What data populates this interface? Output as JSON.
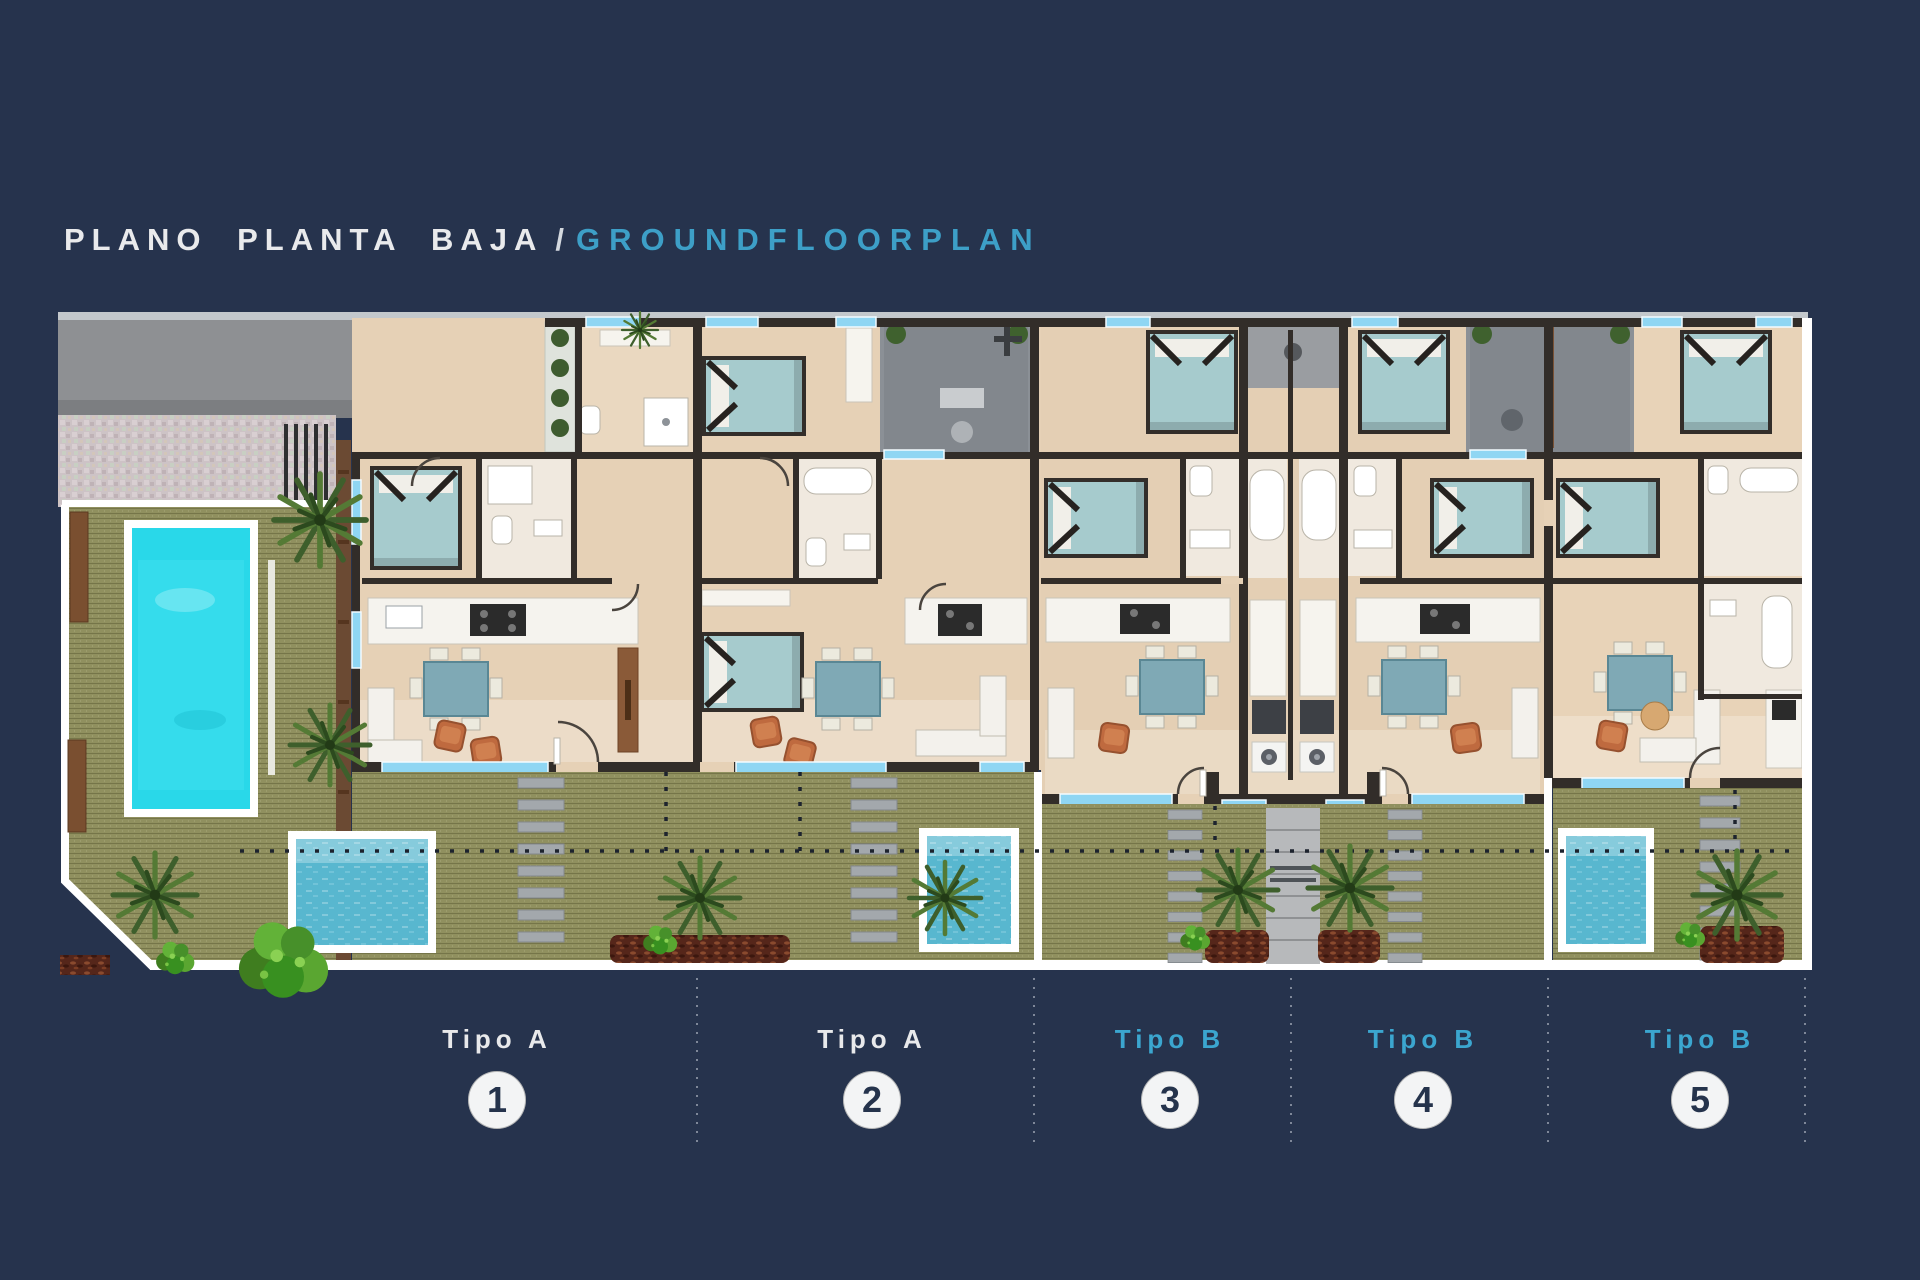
{
  "title": {
    "main": "PLANO PLANTA BAJA",
    "separator": "/",
    "english": "GROUNDFLOORPLAN"
  },
  "units": [
    {
      "id": 1,
      "type": "Tipo A",
      "number": "1",
      "label_color": "#e8e9eb"
    },
    {
      "id": 2,
      "type": "Tipo A",
      "number": "2",
      "label_color": "#e8e9eb"
    },
    {
      "id": 3,
      "type": "Tipo B",
      "number": "3",
      "label_color": "#3ba6cf"
    },
    {
      "id": 4,
      "type": "Tipo B",
      "number": "4",
      "label_color": "#3ba6cf"
    },
    {
      "id": 5,
      "type": "Tipo B",
      "number": "5",
      "label_color": "#3ba6cf"
    }
  ],
  "colors": {
    "background": "#26334d",
    "title_text": "#e9eaec",
    "accent_cyan": "#3d9fc7",
    "badge_fill": "#f3f4f5",
    "badge_number": "#25334c",
    "floor_beige": "#e6d1b6",
    "wall_dark": "#322d29",
    "window_cyan": "#8fd6f3",
    "lawn_olive": "#90905f",
    "main_pool": "#29d8e9",
    "plunge_pool": "#58b7cf",
    "patio_gray": "#8b9096",
    "furniture_teal": "#a6cbcd",
    "terracotta": "#bf6a3f",
    "mulch_red": "#55261a",
    "border_white": "#ffffff"
  }
}
